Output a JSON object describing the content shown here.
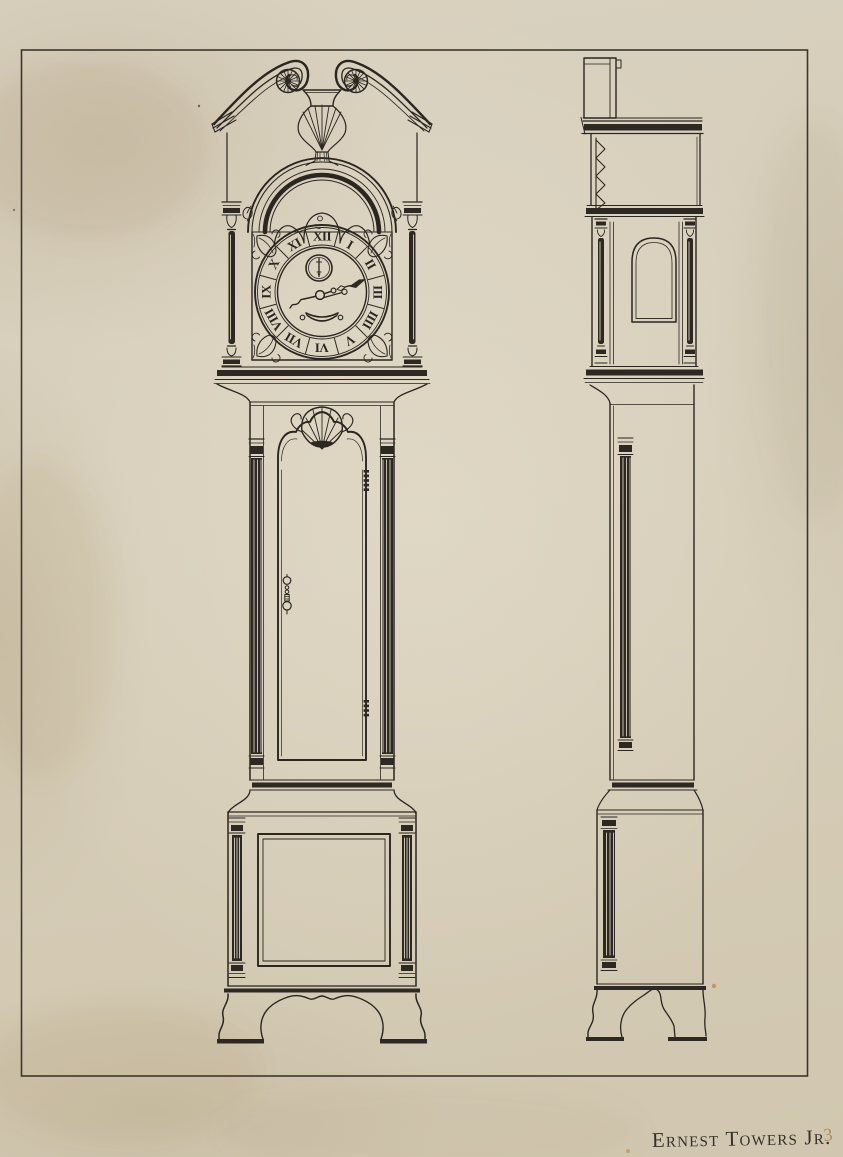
{
  "artwork": {
    "signature": "Ernest Towers Jr.",
    "plate_number": "3",
    "dial_numerals": [
      "XII",
      "I",
      "II",
      "III",
      "IIII",
      "V",
      "VI",
      "VII",
      "VIII",
      "IX",
      "X",
      "XI"
    ],
    "colors": {
      "paper": "#d6ceba",
      "ink": "#2b2620",
      "border": "#3c372e",
      "plate_number": "#b98a52"
    }
  }
}
